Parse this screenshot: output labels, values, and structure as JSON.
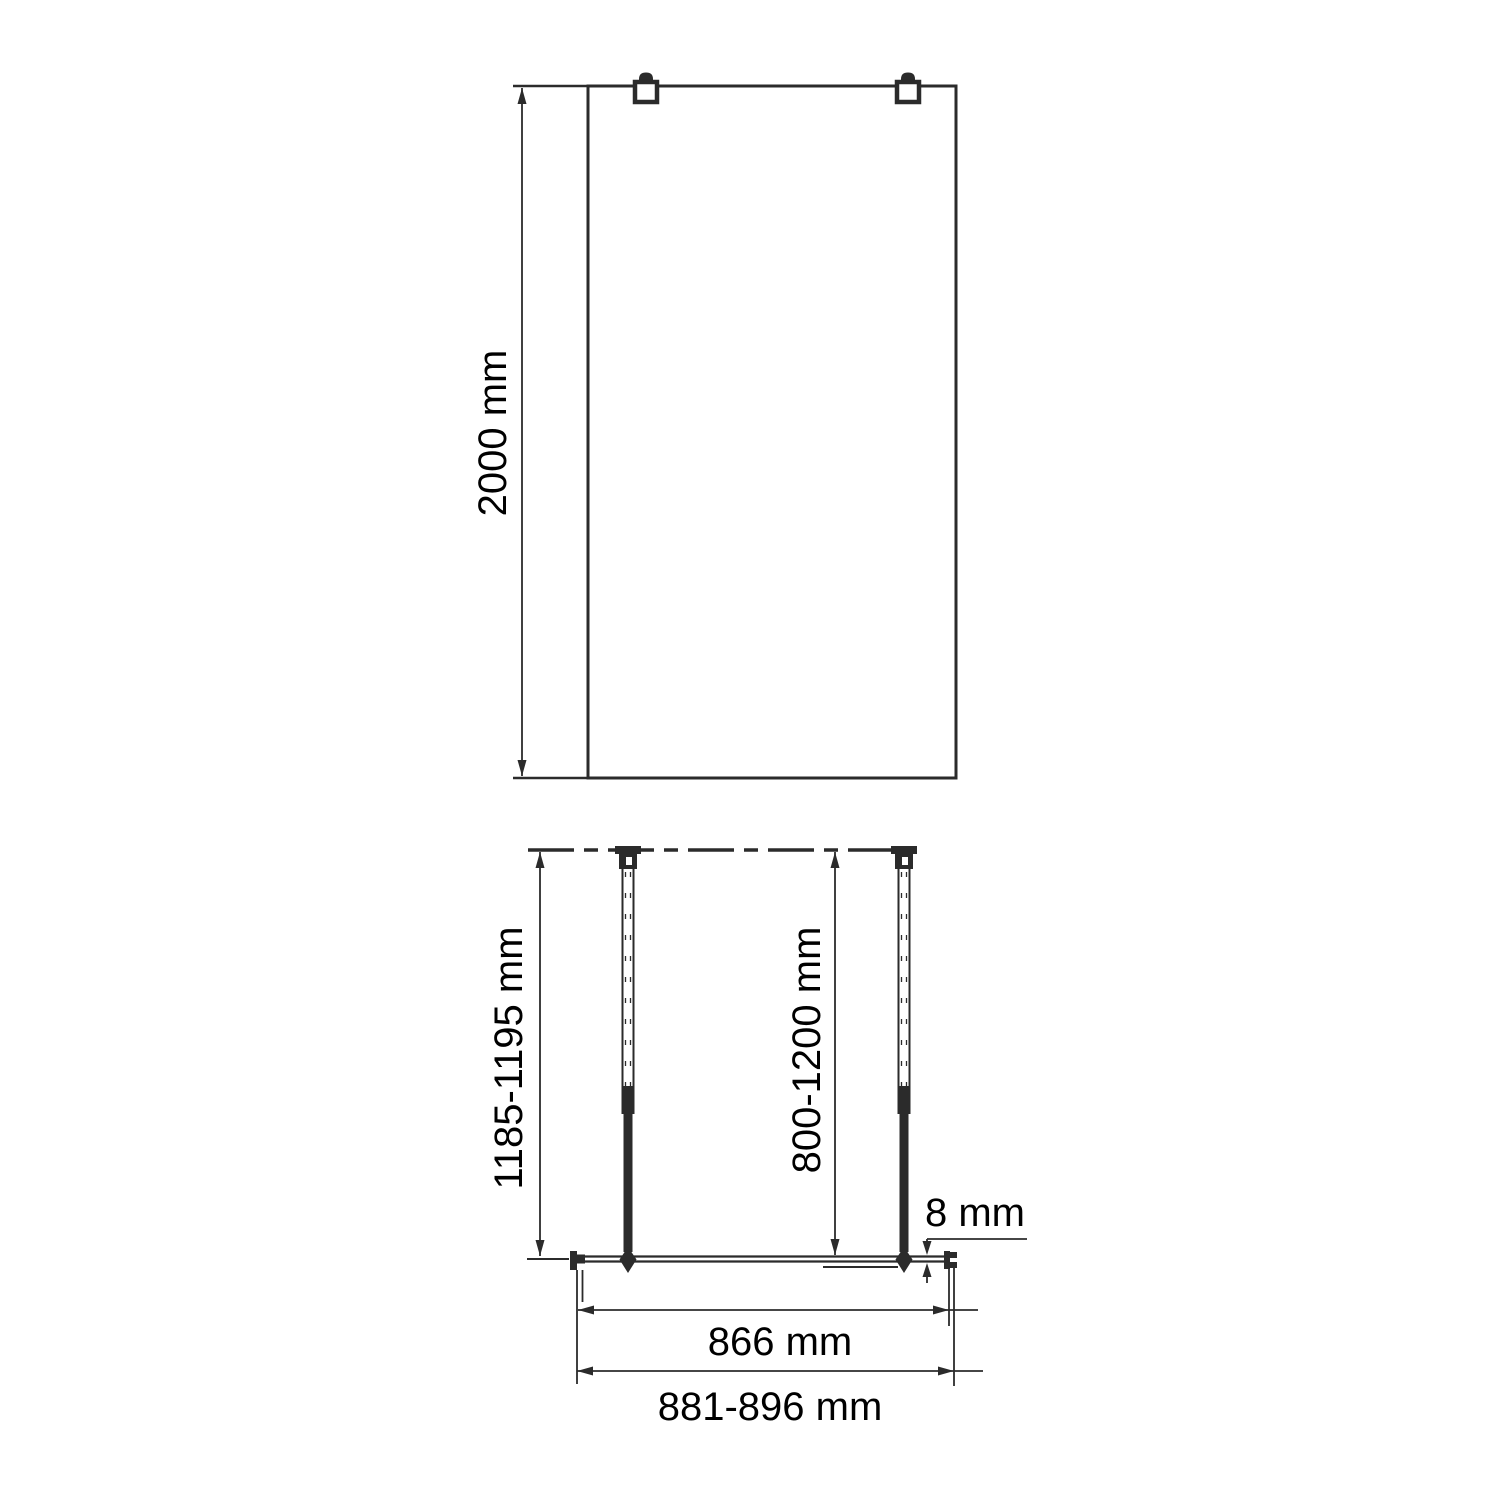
{
  "colors": {
    "line": "#2b2b2b",
    "text": "#000000",
    "background": "#ffffff"
  },
  "front_view": {
    "height_label": "2000 mm"
  },
  "plan_view": {
    "wall_to_glass_label": "1185-1195 mm",
    "support_bar_label": "800-1200 mm",
    "glass_thickness_label": "8 mm",
    "glass_width_label": "866 mm",
    "overall_width_label": "881-896 mm"
  }
}
